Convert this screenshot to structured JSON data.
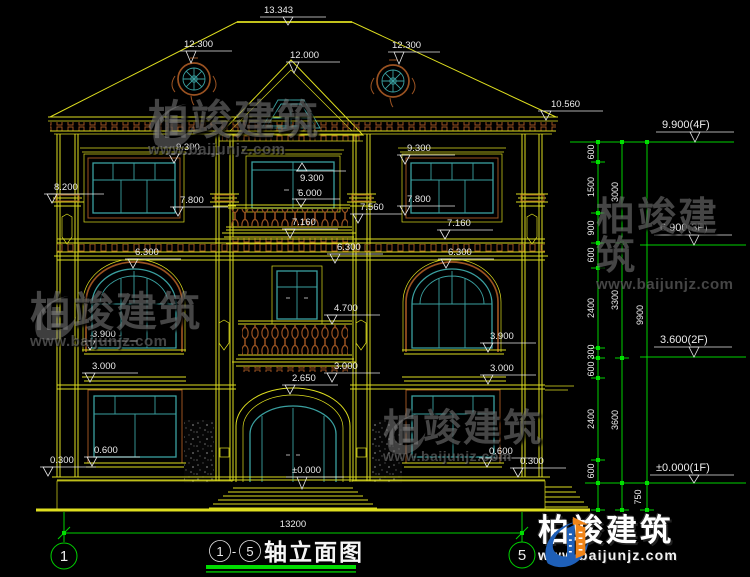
{
  "palette": {
    "background": "#000000",
    "cad_yellow": "#dede1f",
    "window_teal": "#3aa0a0",
    "trim_brown": "#9a5221",
    "dim_green": "#00d200",
    "text_white": "#ececec",
    "logo_blue": "#1e5fb8",
    "logo_orange": "#f08418"
  },
  "watermark": {
    "brand": "柏竣建筑",
    "url": "www.baijunjz.com"
  },
  "brand_logo": {
    "name": "柏竣建筑",
    "url": "www.baijunjz.com"
  },
  "drawing_title": {
    "axis_from": "1",
    "axis_to": "5",
    "separator": "-",
    "text": "轴立面图"
  },
  "axes": {
    "left_bubble": "1",
    "right_bubble": "5",
    "overall_width": "13200"
  },
  "elevation_marks": {
    "ridge": "13.343",
    "roof_left": "12.300",
    "roof_right": "12.300",
    "gable": "12.000",
    "eave_right": "10.560",
    "f3_window_left_head": "9.300",
    "left_capital": "8.200",
    "f3_window_left_sill": "7.800",
    "f3_door_head": "9.300",
    "f3_door_sill": "6.000",
    "f3_window_right_head": "9.300",
    "f3_window_right_sill": "7.800",
    "f3_balcony_rail": "7.560",
    "f3_band_center": "7.160",
    "f3_band_right": "7.160",
    "f2_head_left": "6.300",
    "f2_head_center": "6.300",
    "f2_head_right": "6.300",
    "f2_balcony_rail": "4.700",
    "f2_window_left_sill": "3.900",
    "f2_ledge_left": "3.000",
    "f2_window_right_sill": "3.900",
    "f2_ledge_right": "3.000",
    "f2_balcony_floor": "3.000",
    "f1_door_head": "2.650",
    "f1_floor_center": "±0.000",
    "f1_window_left_sill": "0.600",
    "f1_plinth_left": "0.300",
    "f1_window_right_sill": "0.600",
    "f1_plinth_right": "0.300"
  },
  "right_dimension_chain": {
    "floor_levels": [
      {
        "label": "9.900(4F)"
      },
      {
        "label": "6.900(3F)"
      },
      {
        "label": "3.600(2F)"
      },
      {
        "label": "±0.000(1F)"
      }
    ],
    "inner_segments": [
      "600",
      "1500",
      "900",
      "600",
      "2400",
      "300",
      "600",
      "2400",
      "600"
    ],
    "floor_segments": [
      "3000",
      "3300",
      "3600"
    ],
    "overall": "9900",
    "plinth": "750"
  }
}
